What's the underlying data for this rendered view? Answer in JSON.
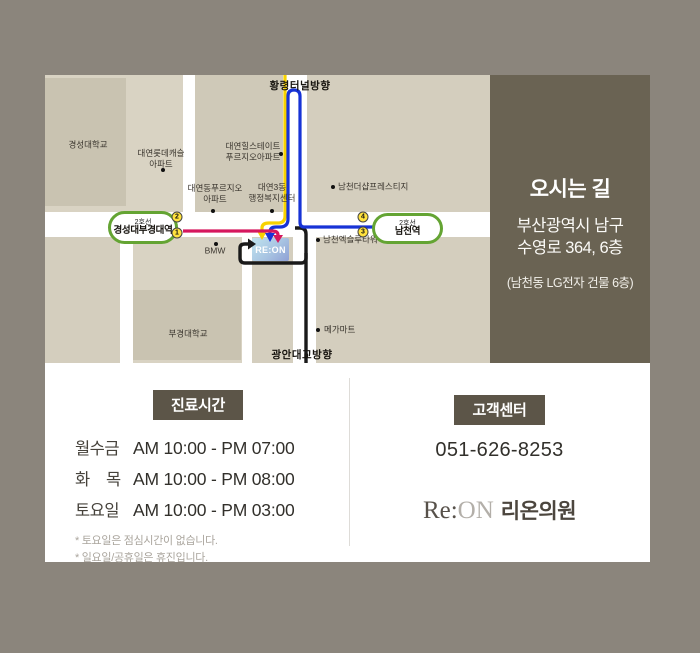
{
  "map": {
    "marker": "RE:ON",
    "top_direction": "황령터널방향",
    "bottom_direction": "광안대교방향",
    "colors": {
      "route_from_tunnel": "#f7d200",
      "route_from_namcheon": "#1733d6",
      "route_from_kyungsung": "#d6175e",
      "route_from_bridge": "#1a1a1a",
      "station_border": "#64a433",
      "exit_circle": "#ffe23d",
      "sidebar_bg": "#6a6353",
      "badge_bg": "#5c5548"
    },
    "stations": [
      {
        "line": "2호선",
        "name": "경성대부경대역",
        "x": 63,
        "y": 136,
        "w": 64,
        "h": 27
      },
      {
        "line": "2호선",
        "name": "남천역",
        "x": 327,
        "y": 138,
        "w": 65,
        "h": 25
      }
    ],
    "exits": [
      {
        "n": "2",
        "x": 132,
        "y": 142
      },
      {
        "n": "1",
        "x": 132,
        "y": 158
      },
      {
        "n": "4",
        "x": 318,
        "y": 142
      },
      {
        "n": "3",
        "x": 318,
        "y": 157
      }
    ],
    "labels": [
      {
        "text": "황령터널방향",
        "x": 255,
        "y": 12,
        "bold": true
      },
      {
        "text": "광안대교방향",
        "x": 257,
        "y": 281,
        "bold": true
      },
      {
        "text": "경성대학교",
        "x": 43,
        "y": 70
      },
      {
        "text": "대연롯데캐슬\n아파트",
        "x": 116,
        "y": 84
      },
      {
        "text": "대연힐스테이트\n푸르지오아파트",
        "x": 208,
        "y": 77
      },
      {
        "text": "대연동푸르지오\n아파트",
        "x": 170,
        "y": 119
      },
      {
        "text": "대연3동\n행정복지센터",
        "x": 227,
        "y": 118
      },
      {
        "text": "남천더샵프레스티지",
        "x": 293,
        "y": 112,
        "align": "left"
      },
      {
        "text": "남천엑슬루타워",
        "x": 278,
        "y": 165,
        "align": "left"
      },
      {
        "text": "BMW",
        "x": 170,
        "y": 176
      },
      {
        "text": "부경대학교",
        "x": 143,
        "y": 259
      },
      {
        "text": "메가마트",
        "x": 279,
        "y": 255,
        "align": "left"
      }
    ],
    "dots": [
      {
        "x": 118,
        "y": 95
      },
      {
        "x": 236,
        "y": 79
      },
      {
        "x": 168,
        "y": 136
      },
      {
        "x": 227,
        "y": 136
      },
      {
        "x": 288,
        "y": 112
      },
      {
        "x": 273,
        "y": 165
      },
      {
        "x": 171,
        "y": 169
      },
      {
        "x": 273,
        "y": 255
      }
    ]
  },
  "sidebar": {
    "title": "오시는 길",
    "address1": "부산광역시 남구",
    "address2": "수영로 364, 6층",
    "note": "(남천동 LG전자 건물 6층)"
  },
  "hours": {
    "badge": "진료시간",
    "rows": [
      {
        "days": "월수금",
        "time": "AM 10:00 - PM 07:00"
      },
      {
        "days": "화    목",
        "time": "AM 10:00 - PM 08:00"
      },
      {
        "days": "토요일",
        "time": "AM 10:00 - PM 03:00"
      }
    ],
    "notes": [
      "* 토요일은 점심시간이 없습니다.",
      "* 일요일/공휴일은 휴진입니다."
    ]
  },
  "contact": {
    "badge": "고객센터",
    "phone": "051-626-8253",
    "logo_re": "Re:",
    "logo_on": "ON",
    "logo_name": "리온의원"
  }
}
